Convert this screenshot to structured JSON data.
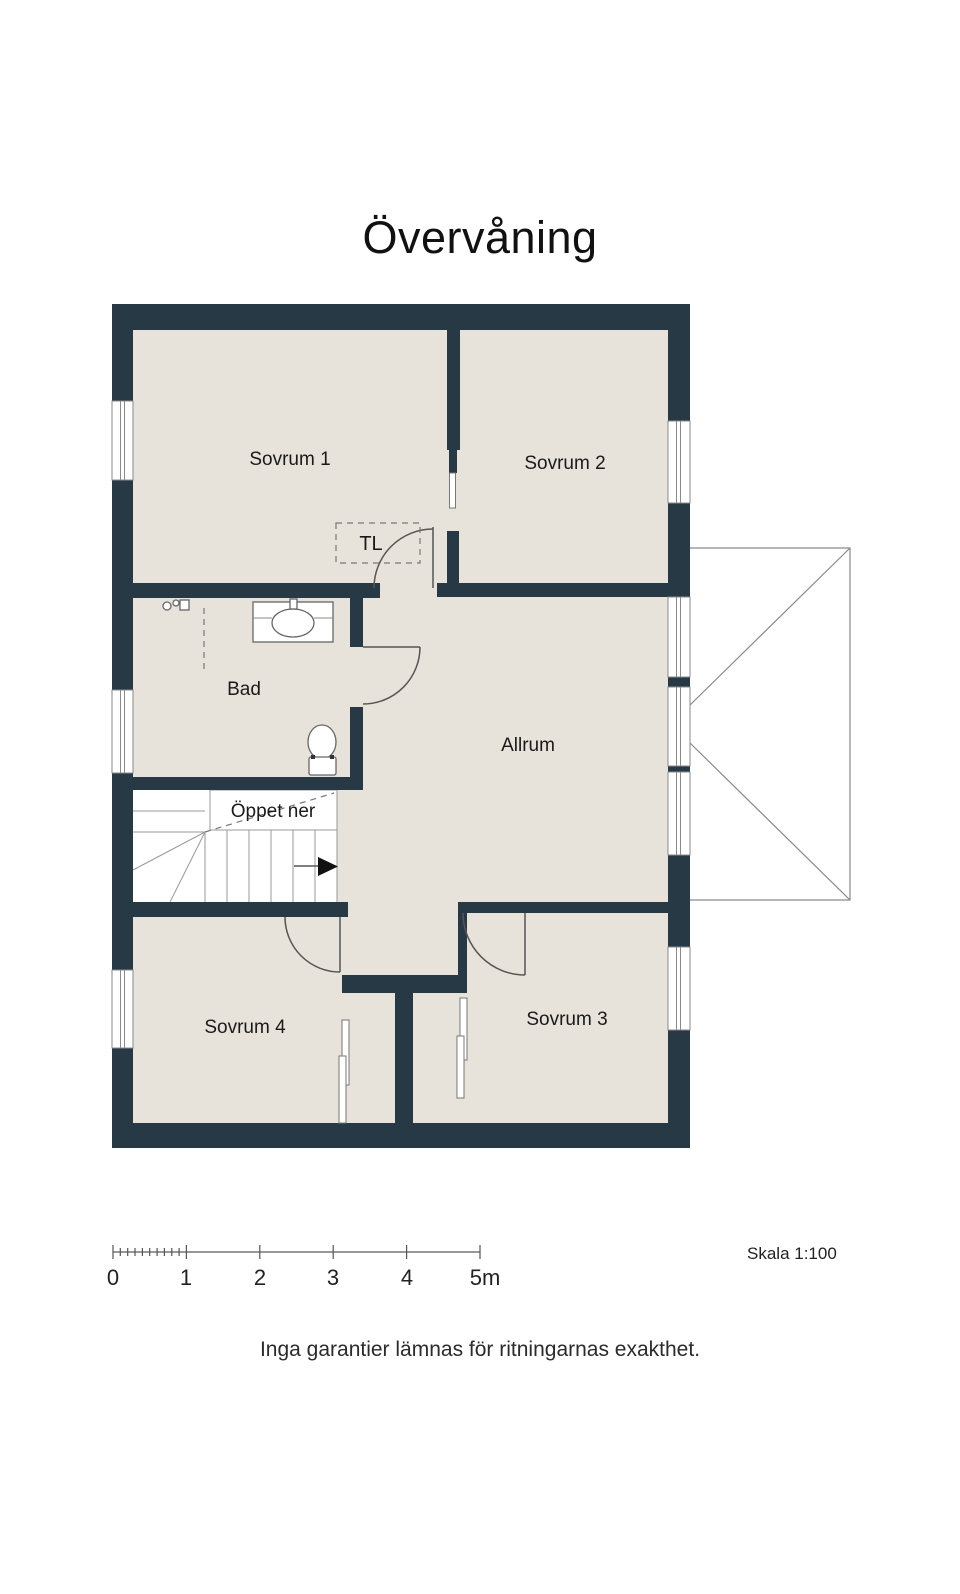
{
  "title": "Övervåning",
  "rooms": {
    "sovrum1": "Sovrum 1",
    "sovrum2": "Sovrum 2",
    "bad": "Bad",
    "allrum": "Allrum",
    "oppet_ner": "Öppet ner",
    "sovrum4": "Sovrum 4",
    "sovrum3": "Sovrum 3",
    "tl": "TL"
  },
  "scale_bar": {
    "tick_labels": [
      "0",
      "1",
      "2",
      "3",
      "4",
      "5m"
    ],
    "note": "Skala 1:100"
  },
  "footer": "Inga garantier lämnas för ritningarnas exakthet.",
  "colors": {
    "wall": "#263945",
    "floor": "#e7e3da",
    "outline": "#8a8a8a"
  }
}
